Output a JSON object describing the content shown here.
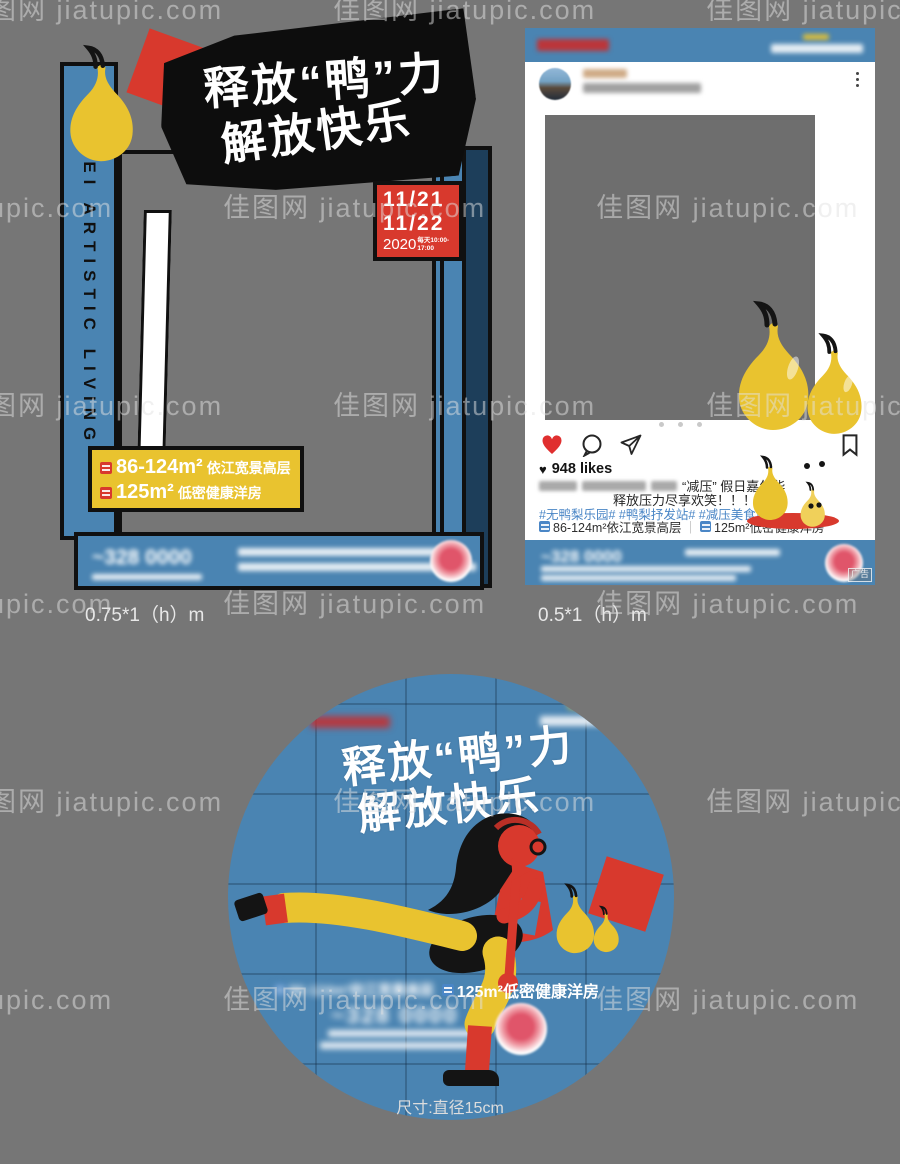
{
  "watermark": {
    "text": "佳图网 jiatupic.com"
  },
  "colors": {
    "blue": "#4a84b2",
    "dark_blue": "#1d3e5a",
    "red": "#d8392d",
    "yellow": "#e9c32f",
    "hashtag_blue": "#4a86c6",
    "bg_gray": "#767676",
    "photo_gray": "#6e6e6e"
  },
  "icons": {
    "heart": "♥"
  },
  "title": {
    "line1": "释放“鸭”力",
    "line2": "解放快乐"
  },
  "frame_prop": {
    "side_text": "JIMEI ARTISTIC LIVING",
    "date1": "11/21",
    "date2": "11/22",
    "year": "2020",
    "time": "每天10:00-17:00",
    "banner_line1_area": "86-124m²",
    "banner_line1_desc": "依江宽景高层",
    "banner_line2_area": "125m²",
    "banner_line2_desc": "低密健康洋房",
    "footer_phone": "~328 0000",
    "size_label": "0.75*1（h）m"
  },
  "social_post": {
    "likes": "948 likes",
    "caption_line1": "“减压” 假日嘉年华",
    "caption_line2": "释放压力尽享欢笑！！！！",
    "hashtags": "#无鸭梨乐园#  #鸭梨抒发站#  #减压美食站#",
    "property1": "86-124m²依江宽景高层",
    "divider": "｜",
    "property2": "125m²低密健康洋房",
    "footer_phone": "~328 0000",
    "ad_tag": "广告",
    "size_label": "0.5*1（h）m"
  },
  "circle_badge": {
    "blurred_property": "86-124m²依江宽景高层",
    "property_label": "125m²低密健康洋房",
    "footer_phone": "~328 0000",
    "size_label": "尺寸:直径15cm"
  }
}
